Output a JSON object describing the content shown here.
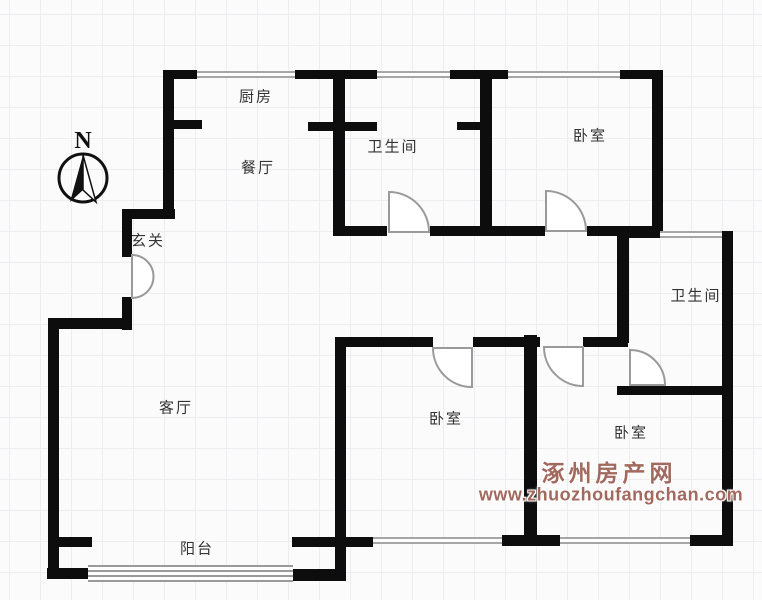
{
  "compass": {
    "label": "N"
  },
  "rooms": [
    {
      "name": "kitchen",
      "label": "厨房",
      "x": 256,
      "y": 97
    },
    {
      "name": "dining-room",
      "label": "餐厅",
      "x": 258,
      "y": 168
    },
    {
      "name": "entry-foyer",
      "label": "玄关",
      "x": 148,
      "y": 241
    },
    {
      "name": "bathroom-top",
      "label": "卫生间",
      "x": 393,
      "y": 147
    },
    {
      "name": "bedroom-top-right",
      "label": "卧室",
      "x": 590,
      "y": 136
    },
    {
      "name": "bathroom-right",
      "label": "卫生间",
      "x": 696,
      "y": 296
    },
    {
      "name": "living-room",
      "label": "客厅",
      "x": 176,
      "y": 408
    },
    {
      "name": "bedroom-middle",
      "label": "卧室",
      "x": 446,
      "y": 419
    },
    {
      "name": "bedroom-bottom-right",
      "label": "卧室",
      "x": 631,
      "y": 433
    },
    {
      "name": "balcony",
      "label": "阳台",
      "x": 197,
      "y": 549
    }
  ],
  "watermark": {
    "line1": "涿州房产网",
    "line2": "www.zhuozhoufangchan.com",
    "color": "#a2695e",
    "x1": 609,
    "y1": 471,
    "x2": 611,
    "y2": 495
  },
  "colors": {
    "wall": "#0d0d0d",
    "window": "#a6a6a6",
    "door_stroke": "#9a9a9a",
    "grid": "#ececf1",
    "label": "#333333"
  },
  "plan": {
    "walls": [
      {
        "x": 163,
        "y": 70,
        "w": 34,
        "h": 9
      },
      {
        "x": 295,
        "y": 70,
        "w": 82,
        "h": 9
      },
      {
        "x": 450,
        "y": 70,
        "w": 58,
        "h": 9
      },
      {
        "x": 620,
        "y": 70,
        "w": 43,
        "h": 9
      },
      {
        "x": 163,
        "y": 70,
        "w": 11,
        "h": 148
      },
      {
        "x": 123,
        "y": 209,
        "w": 52,
        "h": 10
      },
      {
        "x": 122,
        "y": 209,
        "w": 10,
        "h": 48
      },
      {
        "x": 122,
        "y": 297,
        "w": 10,
        "h": 33
      },
      {
        "x": 48,
        "y": 318,
        "w": 79,
        "h": 11
      },
      {
        "x": 48,
        "y": 318,
        "w": 11,
        "h": 260
      },
      {
        "x": 59,
        "y": 537,
        "w": 33,
        "h": 10
      },
      {
        "x": 47,
        "y": 568,
        "w": 45,
        "h": 11
      },
      {
        "x": 290,
        "y": 569,
        "w": 56,
        "h": 12
      },
      {
        "x": 335,
        "y": 337,
        "w": 11,
        "h": 240
      },
      {
        "x": 292,
        "y": 537,
        "w": 81,
        "h": 10
      },
      {
        "x": 165,
        "y": 120,
        "w": 37,
        "h": 9
      },
      {
        "x": 308,
        "y": 122,
        "w": 69,
        "h": 9
      },
      {
        "x": 457,
        "y": 122,
        "w": 24,
        "h": 8
      },
      {
        "x": 333,
        "y": 70,
        "w": 12,
        "h": 166
      },
      {
        "x": 480,
        "y": 78,
        "w": 12,
        "h": 152
      },
      {
        "x": 652,
        "y": 70,
        "w": 11,
        "h": 160
      },
      {
        "x": 333,
        "y": 226,
        "w": 54,
        "h": 10
      },
      {
        "x": 430,
        "y": 226,
        "w": 115,
        "h": 10
      },
      {
        "x": 587,
        "y": 226,
        "w": 76,
        "h": 10
      },
      {
        "x": 618,
        "y": 226,
        "w": 45,
        "h": 12
      },
      {
        "x": 618,
        "y": 231,
        "w": 42,
        "h": 7
      },
      {
        "x": 617,
        "y": 231,
        "w": 12,
        "h": 112
      },
      {
        "x": 722,
        "y": 231,
        "w": 11,
        "h": 315
      },
      {
        "x": 335,
        "y": 337,
        "w": 98,
        "h": 10
      },
      {
        "x": 473,
        "y": 337,
        "w": 67,
        "h": 10
      },
      {
        "x": 583,
        "y": 337,
        "w": 45,
        "h": 10
      },
      {
        "x": 524,
        "y": 335,
        "w": 13,
        "h": 201
      },
      {
        "x": 617,
        "y": 386,
        "w": 110,
        "h": 9
      },
      {
        "x": 502,
        "y": 535,
        "w": 58,
        "h": 11
      },
      {
        "x": 690,
        "y": 535,
        "w": 43,
        "h": 11
      }
    ],
    "windows": [
      {
        "x": 197,
        "y": 71,
        "w": 98,
        "h": 7,
        "t": "double"
      },
      {
        "x": 377,
        "y": 71,
        "w": 73,
        "h": 7,
        "t": "double"
      },
      {
        "x": 508,
        "y": 71,
        "w": 112,
        "h": 7,
        "t": "double"
      },
      {
        "x": 660,
        "y": 231,
        "w": 62,
        "h": 7,
        "t": "double"
      },
      {
        "x": 373,
        "y": 537,
        "w": 129,
        "h": 7,
        "t": "double"
      },
      {
        "x": 560,
        "y": 537,
        "w": 130,
        "h": 7,
        "t": "double"
      },
      {
        "x": 88,
        "y": 565,
        "w": 205,
        "h": 17,
        "t": "band"
      }
    ],
    "doors": [
      {
        "name": "entrance-door",
        "path": "M132,255 A21.5,21.5 0 0 1 132,298 Z"
      },
      {
        "name": "bathroom-top-door",
        "path": "M389,232 L389,192 A40,40 0 0 1 429,232 Z"
      },
      {
        "name": "bedroom-top-right-door",
        "path": "M546,231 L546,191 A40,40 0 0 1 586,231 Z"
      },
      {
        "name": "bedroom-middle-door",
        "path": "M472,348 L433,348 A39,39 0 0 0 472,387 Z"
      },
      {
        "name": "bedroom-bottom-right-door",
        "path": "M583,347 L544,347 A39,39 0 0 0 583,386 Z"
      },
      {
        "name": "bathroom-right-door",
        "path": "M630,385 L630,350 A35,35 0 0 1 665,385 Z"
      }
    ]
  }
}
